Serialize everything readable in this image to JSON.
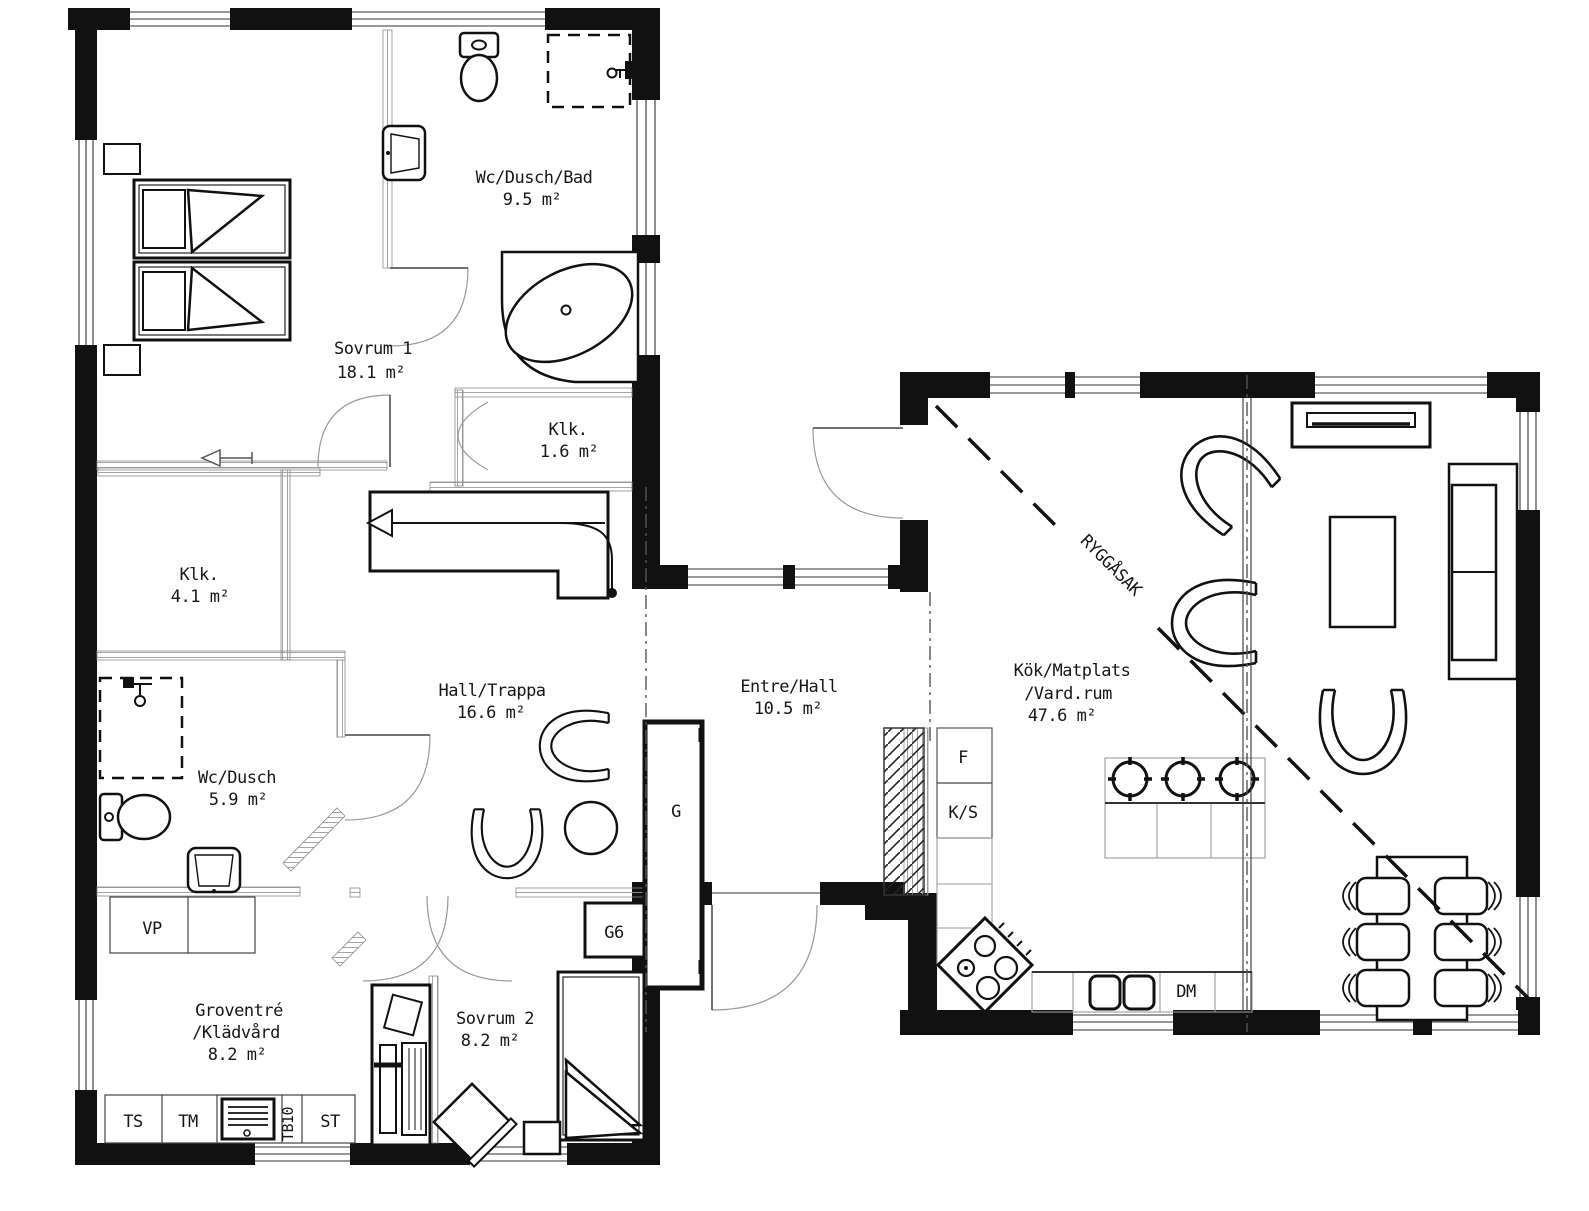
{
  "colors": {
    "ink": "#161616",
    "background": "#ffffff",
    "light_line": "#8a8a8a"
  },
  "rooms": {
    "wc_dusch_bad": {
      "name": "Wc/Dusch/Bad",
      "area": "9.5 m²"
    },
    "sovrum_1": {
      "name": "Sovrum 1",
      "area": "18.1 m²"
    },
    "klk_liten": {
      "name": "Klk.",
      "area": "1.6 m²"
    },
    "klk_stor": {
      "name": "Klk.",
      "area": "4.1 m²"
    },
    "hall_trappa": {
      "name": "Hall/Trappa",
      "area": "16.6 m²"
    },
    "entre_hall": {
      "name": "Entre/Hall",
      "area": "10.5 m²"
    },
    "wc_dusch": {
      "name": "Wc/Dusch",
      "area": "5.9 m²"
    },
    "groventre": {
      "name_line1": "Groventré",
      "name_line2": "/Klädvård",
      "area": "8.2 m²"
    },
    "sovrum_2": {
      "name": "Sovrum 2",
      "area": "8.2 m²"
    },
    "kok": {
      "name_line1": "Kök/Matplats",
      "name_line2": "/Vard.rum",
      "area": "47.6 m²"
    }
  },
  "appliances": {
    "vp": "VP",
    "ts": "TS",
    "tm": "TM",
    "tb10": "TB10",
    "st": "ST",
    "dm": "DM",
    "f": "F",
    "ks": "K/S"
  },
  "storage": {
    "g": "G",
    "g6": "G6"
  },
  "annotations": {
    "ridge_label": "RYGGÅSAK"
  }
}
